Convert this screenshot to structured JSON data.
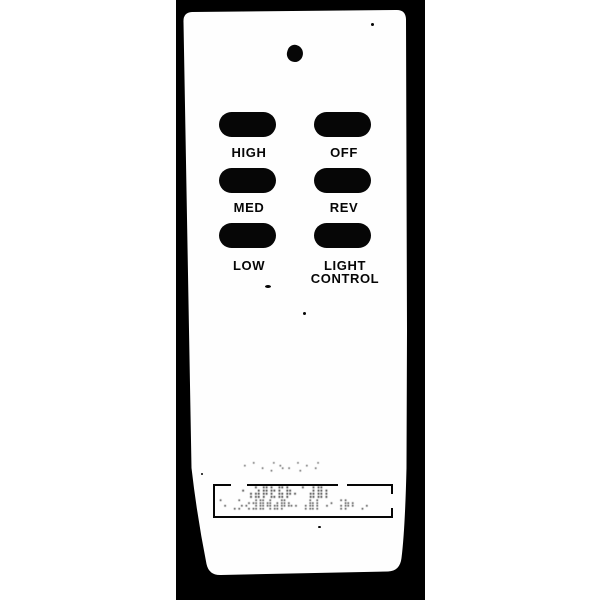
{
  "colors": {
    "page": "#ffffff",
    "backdrop": "#000000",
    "body": "#fefefe",
    "ink": "#060606"
  },
  "remote": {
    "kind": "ceiling-fan-remote-control",
    "buttons": {
      "high": {
        "label": "HIGH"
      },
      "off": {
        "label": "OFF"
      },
      "med": {
        "label": "MED"
      },
      "rev": {
        "label": "REV"
      },
      "low": {
        "label": "LOW"
      },
      "light": {
        "label_line1": "LIGHT",
        "label_line2": "CONTROL"
      }
    },
    "label_plate": {
      "legibility": "illegible",
      "noise_above": "⠂⠁⠄⡈⠢⠄⢁⠂⠌",
      "noise_line1": "⠐⢠⣵⡿⣗⣯⡷⠄⠁⣼⣿⡆",
      "noise_line2": "⠈⠄⢀⡡⢔⣺⣿⢾⣴⡿⠦⠄⢠⣷⡇⠠⠂⢨⡷⠆⢀⠄"
    }
  }
}
